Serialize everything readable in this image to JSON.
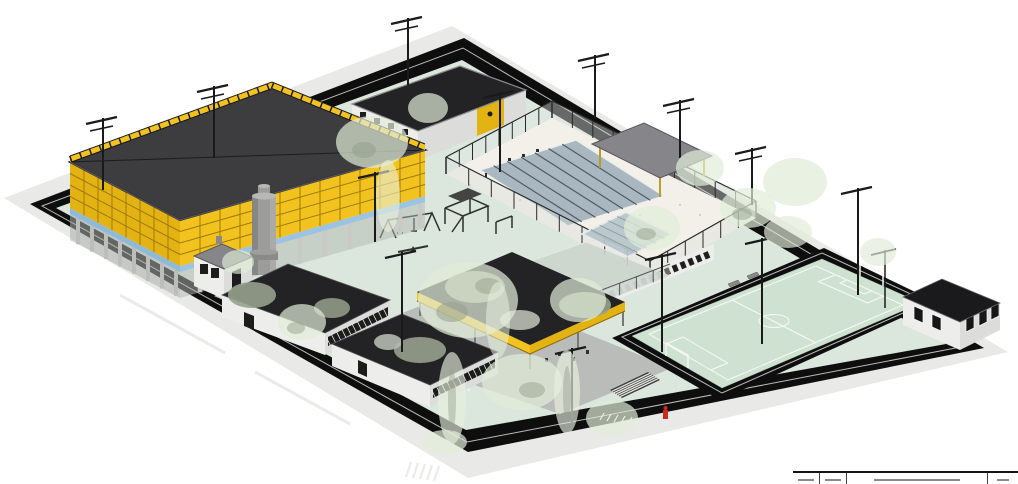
{
  "meta": {
    "type": "architectural-3d-site-rendering",
    "view": "axonometric"
  },
  "scene": {
    "colors": {
      "background": "#ffffff",
      "sidewalk": "#e9e9e7",
      "wall_black": "#0e0e0f",
      "ground_green": "#dbe7dc",
      "paving": "#b9bcb8",
      "path_gray": "#c9cbc7",
      "roof_dark": "#3d3d3f",
      "roof_black": "#232325",
      "facade_yellow": "#f2c31e",
      "facade_yellow_dark": "#e3b314",
      "facade_grout": "#a07a06",
      "glazing_blue": "#8fb9d8",
      "column_gray": "#bdbdbb",
      "wall_white": "#ededeb",
      "wall_white_shade": "#dcdcda",
      "window_dark": "#1c1c1c",
      "pool_water": "#a9b7c0",
      "pool_lane": "#4e5a62",
      "pool_deck": "#f2f0e8",
      "field_green": "#cfe2d1",
      "line_white": "#fbfbf8",
      "tree_canopy": "#e1ecd8",
      "tree_olive": "#97a18d",
      "tree_light": "#e8f0de",
      "metal_gray": "#86868a",
      "tower_gray": "#9c9c9a",
      "hydrant_red": "#cc2a1e",
      "lamp_black": "#1a1a1a",
      "glass_canopy": "#b7c5ca",
      "fence_dark": "#2a2a2a",
      "shelter_legs": "#b99b2e"
    },
    "elements": [
      {
        "name": "perimeter-wall"
      },
      {
        "name": "sidewalk"
      },
      {
        "name": "gymnasium-building"
      },
      {
        "name": "water-tower"
      },
      {
        "name": "guard-house"
      },
      {
        "name": "changing-rooms-building"
      },
      {
        "name": "swimming-pool"
      },
      {
        "name": "pool-shelter"
      },
      {
        "name": "playground"
      },
      {
        "name": "covered-pavilion"
      },
      {
        "name": "classroom-block-a"
      },
      {
        "name": "classroom-block-b"
      },
      {
        "name": "corridor-building"
      },
      {
        "name": "sports-court"
      },
      {
        "name": "glass-canopy"
      },
      {
        "name": "football-field"
      },
      {
        "name": "goal"
      },
      {
        "name": "service-building"
      },
      {
        "name": "street-lamps"
      },
      {
        "name": "trees"
      },
      {
        "name": "parking-area"
      },
      {
        "name": "stairs"
      },
      {
        "name": "crosswalk"
      },
      {
        "name": "fire-hydrant"
      }
    ]
  },
  "title_block": {
    "cells": [
      "",
      "",
      "",
      ""
    ]
  }
}
